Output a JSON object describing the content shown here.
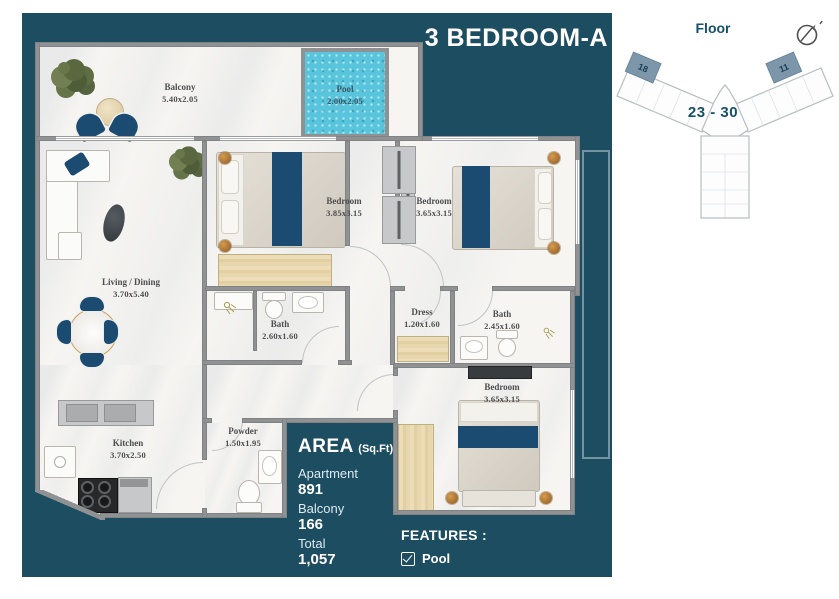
{
  "header": {
    "title": "3 BEDROOM-A"
  },
  "key_plan": {
    "label": "Floor",
    "floor_range": "23 - 30",
    "highlighted_unit_left": "18",
    "highlighted_unit_right": "11"
  },
  "rooms": {
    "balcony": {
      "name": "Balcony",
      "dims": "5.40x2.05"
    },
    "pool": {
      "name": "Pool",
      "dims": "2.00x2.05"
    },
    "living": {
      "name": "Living / Dining",
      "dims": "3.70x5.40"
    },
    "bedroom1": {
      "name": "Bedroom",
      "dims": "3.85x3.15"
    },
    "bedroom2": {
      "name": "Bedroom",
      "dims": "3.65x3.15"
    },
    "bath1": {
      "name": "Bath",
      "dims": "2.60x1.60"
    },
    "dress": {
      "name": "Dress",
      "dims": "1.20x1.60"
    },
    "bath2": {
      "name": "Bath",
      "dims": "2.45x1.60"
    },
    "bedroom3": {
      "name": "Bedroom",
      "dims": "3.65x3.15"
    },
    "kitchen": {
      "name": "Kitchen",
      "dims": "3.70x2.50"
    },
    "powder": {
      "name": "Powder",
      "dims": "1.50x1.95"
    }
  },
  "area_panel": {
    "heading": "AREA",
    "unit_suffix": "(Sq.Ft)",
    "apartment_label": "Apartment",
    "apartment_value": "891",
    "balcony_label": "Balcony",
    "balcony_value": "166",
    "total_label": "Total",
    "total_value": "1,057"
  },
  "features_panel": {
    "heading": "FEATURES :",
    "pool_label": "Pool",
    "pool_checked": true
  },
  "colors": {
    "panel_teal": "#1d4d61",
    "accent_navy": "#1b4b70",
    "pool_aqua": "#58c5dc",
    "unit_highlight": "#7e96aa",
    "key_text": "#15516c"
  }
}
